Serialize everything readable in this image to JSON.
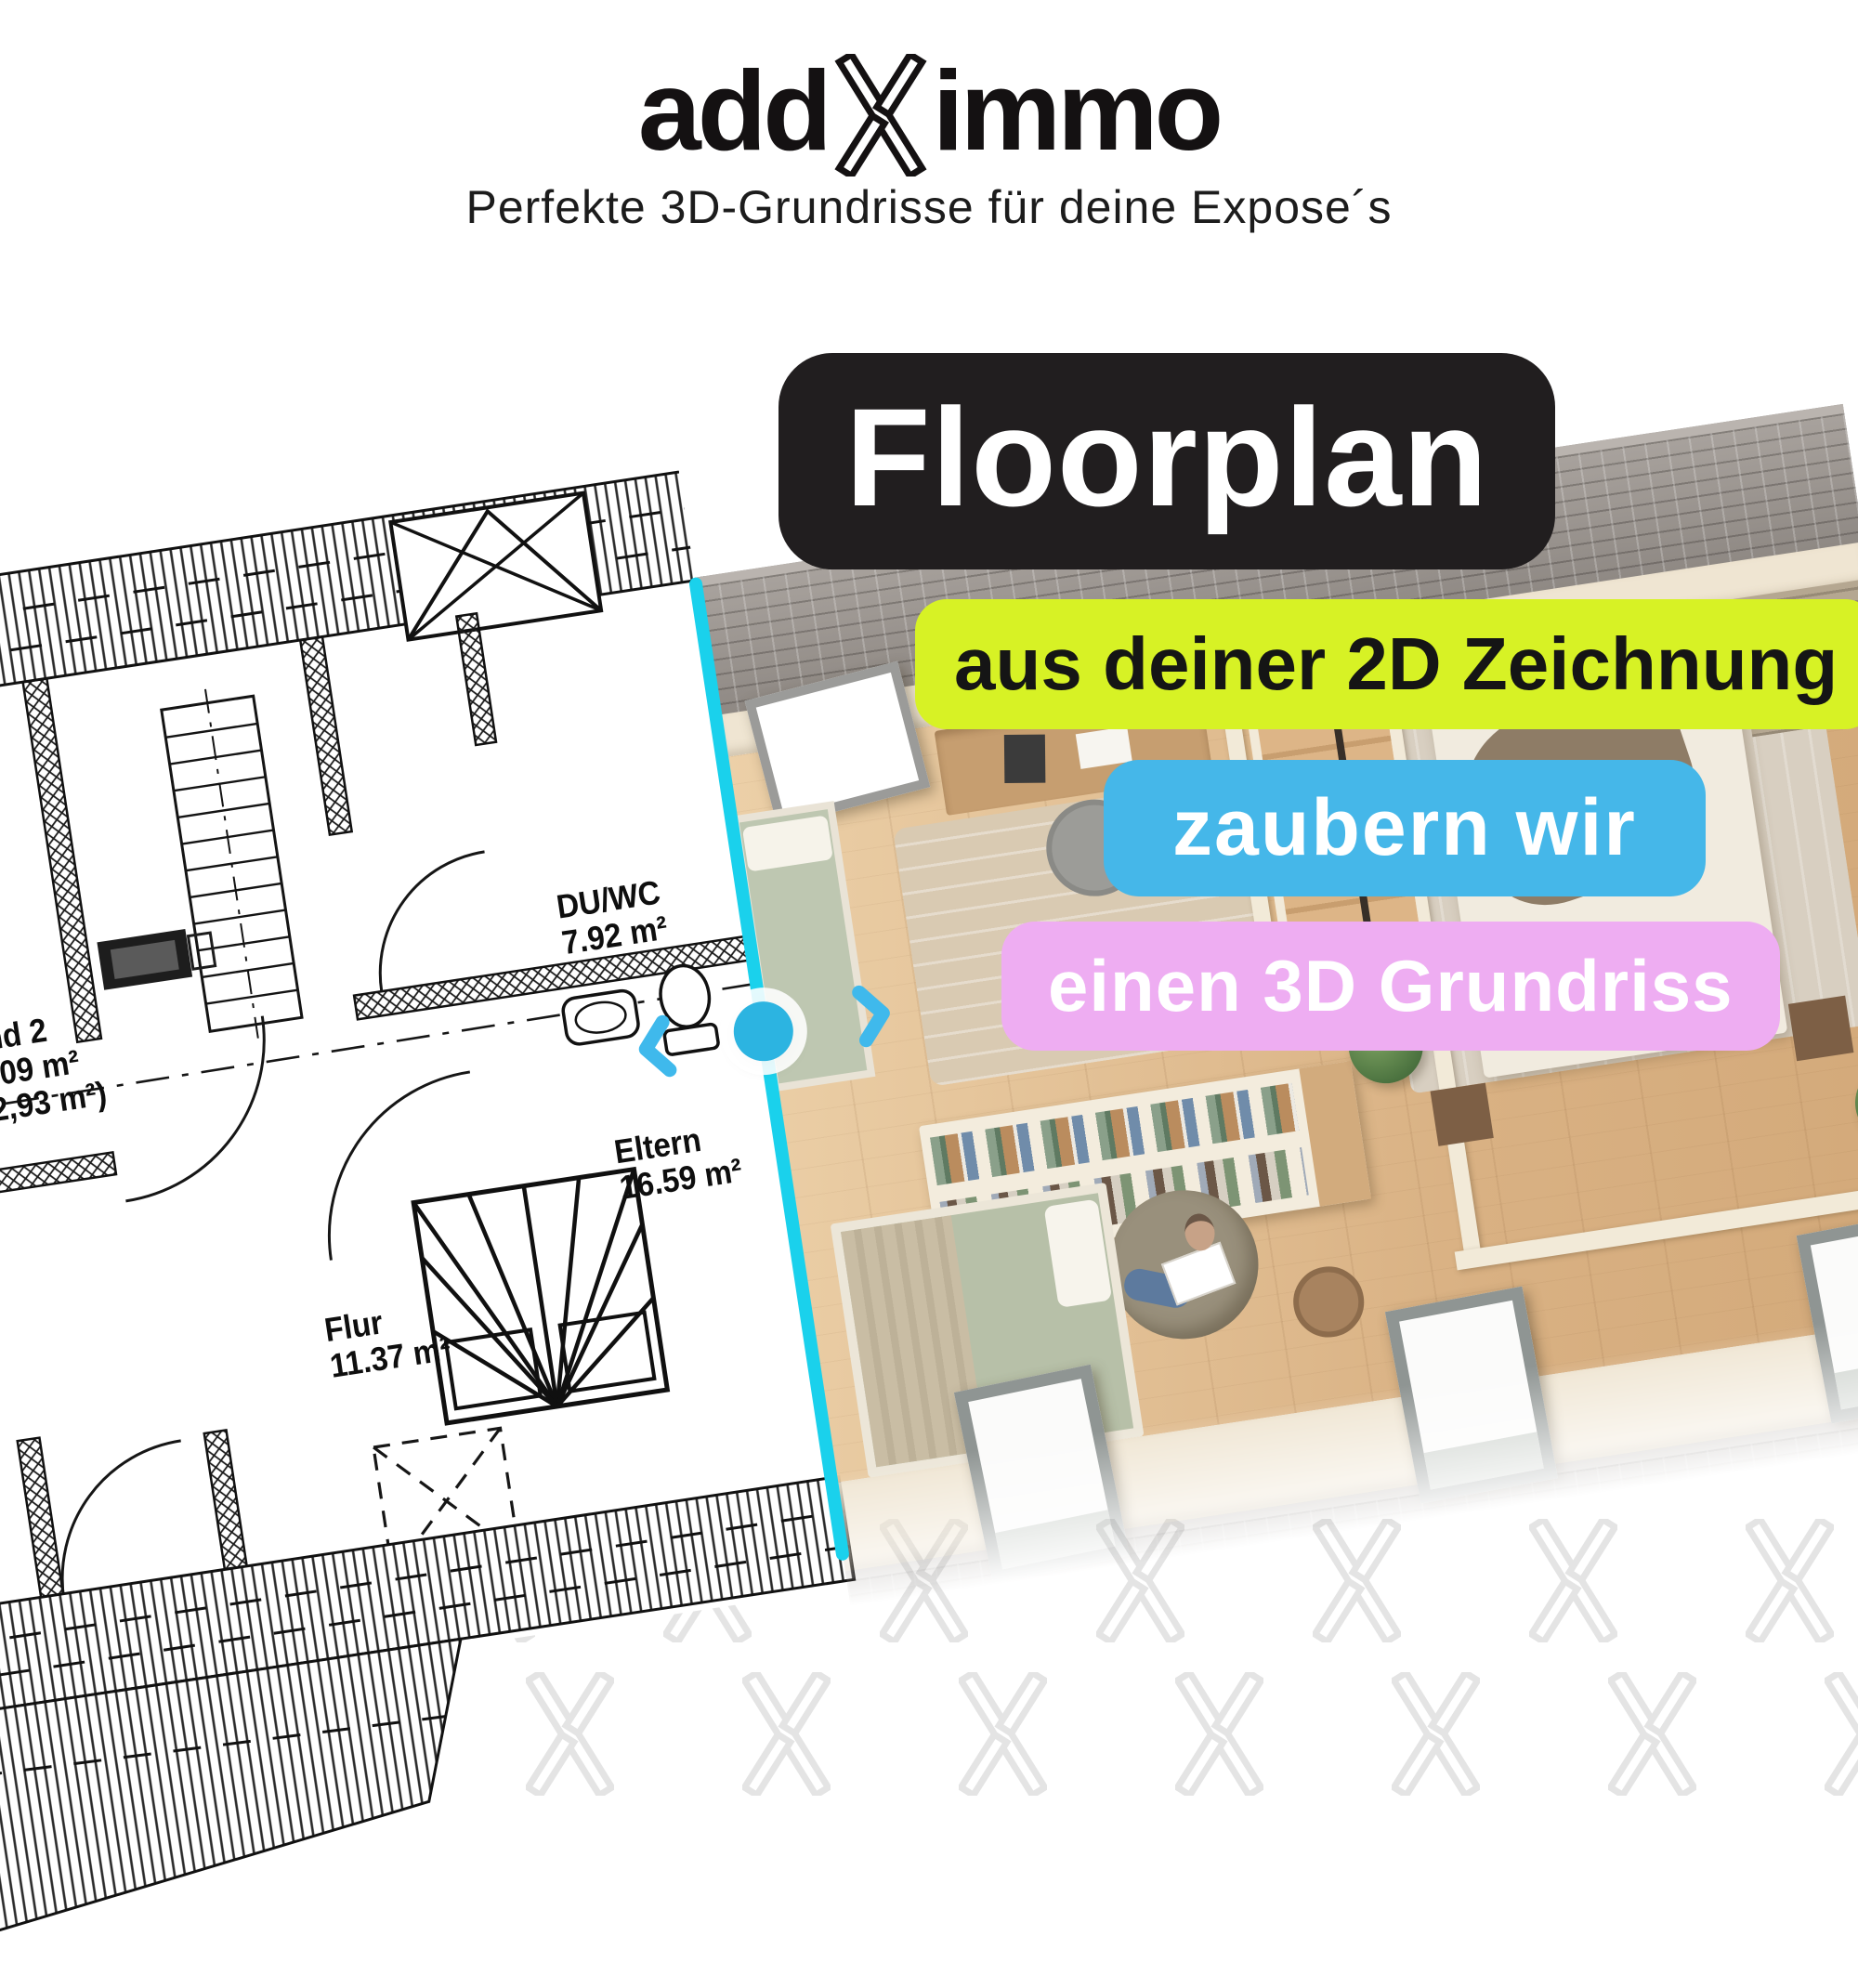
{
  "header": {
    "logo": {
      "part1": "add",
      "part2": "immo"
    },
    "tagline": "Perfekte 3D-Grundrisse für deine Expose´s"
  },
  "badges": {
    "title": "Floorplan",
    "line1": "aus deiner 2D Zeichnung",
    "line2": "zaubern wir",
    "line3": "einen 3D Grundriss"
  },
  "plan": {
    "rooms": [
      {
        "name": "Kind 2",
        "area": "11.09 m²",
        "area_alt": "(12,93 m²)"
      },
      {
        "name": "DU/WC",
        "area": "7.92 m²"
      },
      {
        "name": "Eltern",
        "area": "16.59 m²"
      },
      {
        "name": "Flur",
        "area": "11.37 m²"
      }
    ],
    "edge_fragments": [
      "m²",
      "m²)"
    ]
  },
  "slider": {
    "divider_color": "#1ad1ec",
    "handle_color": "#2cb4e1",
    "arrow_color": "#3fb9ec",
    "handle_icon": "slider-handle",
    "left_icon": "chevron-left-icon",
    "right_icon": "chevron-right-icon"
  },
  "colors": {
    "title_badge_bg": "#211e1f",
    "line1_badge_bg": "#d7f225",
    "line2_badge_bg": "#45b7e9",
    "line3_badge_bg": "#eeadf2",
    "watermark": "#e6e6e6"
  }
}
